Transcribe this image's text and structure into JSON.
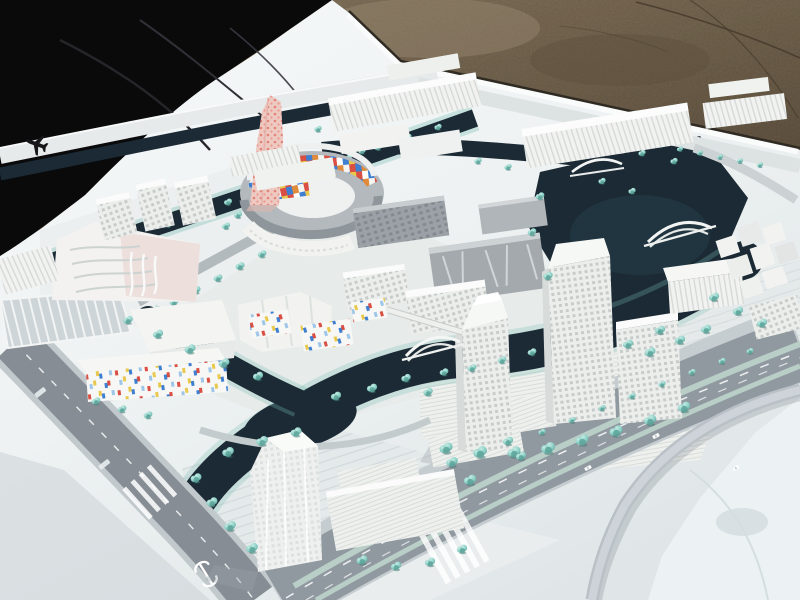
{
  "meta": {
    "type": "photograph",
    "subject": "Aerial photograph of a white architectural scale model of a waterfront urban district displayed outdoors on gravel ground",
    "no_visible_text": "All lettering in the photo (small street labels) is too small to read"
  },
  "palette": {
    "tarp_black": "#0a0a0b",
    "gravel_brown": "#71624d",
    "gravel_dark": "#574a38",
    "gravel_light": "#8d7c64",
    "board_white": "#f1f4f4",
    "board_shadow": "#ccd3d6",
    "water_navy": "#1b2a35",
    "water_teal": "#2e4a52",
    "shore_teal": "#79bdb4",
    "tree_teal": "#8ccfc6",
    "tree_teal_dark": "#5da49b",
    "road_gray": "#868d94",
    "road_light": "#aab2b8",
    "building_white": "#f2f3f1",
    "building_shade": "#d7dbd9",
    "building_gray": "#9da3a8",
    "tower_pink": "#eec9c2",
    "pink_dot_red": "#df7c6f",
    "mosaic_red": "#d94f43",
    "mosaic_blue": "#3f7fd1",
    "mosaic_yellow": "#e8c94e",
    "mosaic_orange": "#e08a3c",
    "lot_ice": "#ecf2f4",
    "marking_white": "#ffffff"
  },
  "scene": {
    "background": {
      "ground_label": "cracked gravel-concrete ground",
      "tarp_label": "black tarp cover",
      "board_label": "white model baseboard"
    },
    "landmarks": {
      "pink_tower": "twisted pale-pink tower with red dotted facade",
      "ring_building": "circular courtyard building with multicolored mosaic inner facade",
      "confetti_blocks": "low-rise blocks with scattered red, yellow and blue window panels",
      "slab_buildings": "long white slab buildings with vertical fins along the rear canal",
      "metal_blocks": "silver-gray office blocks beside the ring building",
      "tower_trio": "three white high-rise towers on a canal-front island",
      "waterfront_tower": "translucent white high-rise with stepped podium and plaza",
      "cube_cluster": "dense cluster of small white blocks at the right edge",
      "left_complex": "large white complex with wavy ribbed roof",
      "parking_lot": "striped surface parking rows",
      "canals": "dark navy canal network with teal planted banks",
      "bridges": "white arch footbridges over the canals",
      "flyover": "curved highway flyover ramp",
      "open_lot": "pale vacant parcel at lower right",
      "trees": "teal foam model trees"
    },
    "markings": {
      "airplane_icon": "black airplane silhouette on the approach viaduct",
      "rail_logo": "white rail-transit logo painted on the roadway",
      "crosswalks": "white zebra crossings",
      "lane_dashes": "white lane markings",
      "road_labels": "tiny illegible white street labels",
      "cars": "small white model cars"
    },
    "counts": {
      "arch_bridges": 3,
      "high_rise_towers": 5
    }
  }
}
